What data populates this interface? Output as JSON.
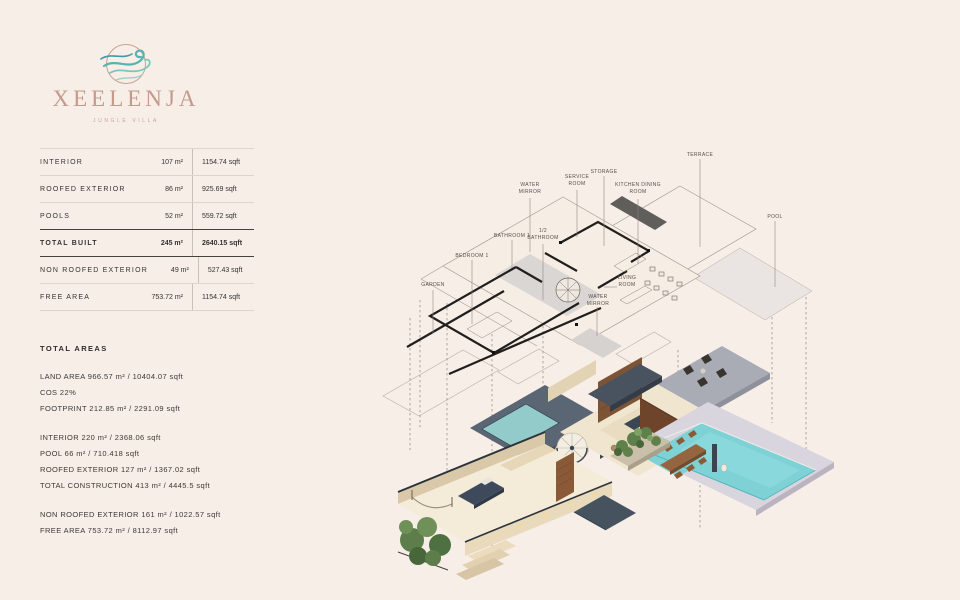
{
  "brand": {
    "name": "XEELENJA",
    "subtitle": "JUNGLE VILLA",
    "logo_icon": "wind-swirl-logo"
  },
  "summary_table": {
    "rows": [
      {
        "label": "INTERIOR",
        "m2": "107 m²",
        "sqft": "1154.74 sqft"
      },
      {
        "label": "ROOFED EXTERIOR",
        "m2": "86 m²",
        "sqft": "925.69 sqft"
      },
      {
        "label": "POOLS",
        "m2": "52 m²",
        "sqft": "559.72 sqft"
      },
      {
        "label": "TOTAL BUILT",
        "m2": "245 m²",
        "sqft": "2640.15 sqft"
      },
      {
        "label": "NON ROOFED EXTERIOR",
        "m2": "49 m²",
        "sqft": "527.43 sqft"
      },
      {
        "label": "FREE AREA",
        "m2": "753.72 m²",
        "sqft": "1154.74 sqft"
      }
    ]
  },
  "total_areas": {
    "heading": "TOTAL AREAS",
    "g1": [
      "LAND AREA  966.57 m² / 10404.07 sqft",
      "COS  22%",
      "FOOTPRINT  212.85 m² / 2291.09 sqft"
    ],
    "g2": [
      "INTERIOR  220 m² / 2368.06 sqft",
      "POOL  66 m² / 710.418 sqft",
      "ROOFED EXTERIOR  127 m² / 1367.02 sqft",
      "TOTAL CONSTRUCTION  413 m² / 4445.5 sqft"
    ],
    "g3": [
      "NON ROOFED EXTERIOR  161 m² / 1022.57 sqft",
      "FREE AREA  753.72 m² / 8112.97 sqft"
    ]
  },
  "plan_labels": {
    "water_mirror_top": "WATER MIRROR",
    "service_room": "SERVICE ROOM",
    "storage": "STORAGE",
    "kitchen_dining": "KITCHEN DINING ROOM",
    "terrace": "TERRACE",
    "pool": "POOL",
    "bathroom1": "BATHROOM 1",
    "half_bathroom": "1/2 BATHROOM",
    "bedroom1": "BEDROOM 1",
    "garden": "GARDEN",
    "living_room": "LIVING ROOM",
    "water_mirror_bottom": "WATER MIRROR"
  },
  "colors": {
    "background": "#f7eee8",
    "brand_rose": "#c49a8a",
    "brand_teal": "#58b3b0",
    "pool_water": "#7ed2d6",
    "slate_navy": "#3c4552",
    "wall_beige": "#e9dabb",
    "deck_lavender": "#d9d5df",
    "patio_gray": "#a9abb5",
    "plan_gray": "#dad6d4",
    "wood": "#8a5a38",
    "green": "#60804b",
    "text": "#33312e"
  }
}
